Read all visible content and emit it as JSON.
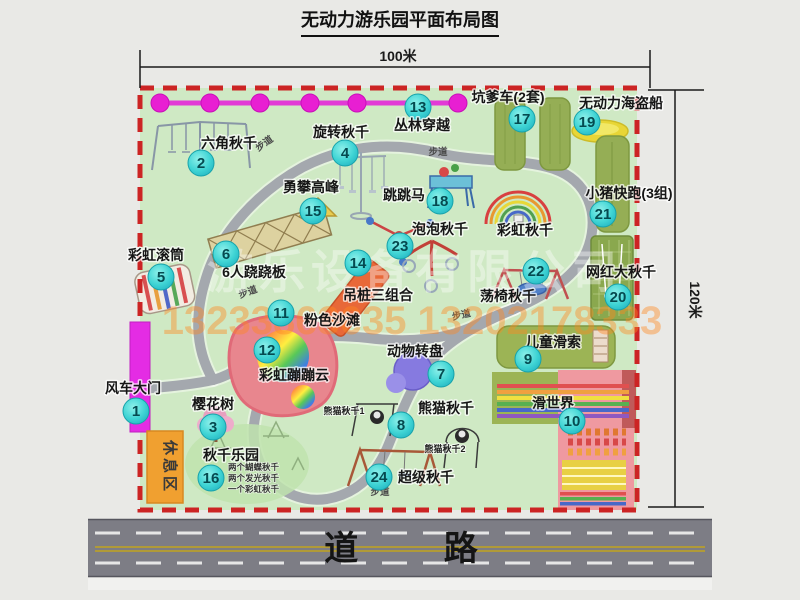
{
  "title": "无动力游乐园平面布局图",
  "dimensions": {
    "width": "100米",
    "height": "120米"
  },
  "road": {
    "label": "道 路"
  },
  "watermark": {
    "company": "游乐设备有限公司",
    "phone": "13233863635 13202178333"
  },
  "rest_area": "休息区",
  "walkway_label": "步道",
  "attractions": [
    {
      "num": "1",
      "label": "风车大门"
    },
    {
      "num": "2",
      "label": "六角秋千"
    },
    {
      "num": "3",
      "label": "樱花树"
    },
    {
      "num": "4",
      "label": "旋转秋千"
    },
    {
      "num": "5",
      "label": "彩虹滚筒"
    },
    {
      "num": "6",
      "label": "6人跷跷板"
    },
    {
      "num": "7",
      "label": "动物转盘"
    },
    {
      "num": "8",
      "label": "熊猫秋千"
    },
    {
      "num": "9",
      "label": "儿童滑索"
    },
    {
      "num": "10",
      "label": "滑世界"
    },
    {
      "num": "11",
      "label": "粉色沙滩"
    },
    {
      "num": "12",
      "label": "彩虹蹦蹦云"
    },
    {
      "num": "13",
      "label": "丛林穿越"
    },
    {
      "num": "14",
      "label": "吊桩三组合"
    },
    {
      "num": "15",
      "label": "勇攀高峰"
    },
    {
      "num": "16",
      "label": "秋千乐园",
      "notes": [
        "两个蝴蝶秋千",
        "两个发光秋千",
        "一个彩虹秋千"
      ]
    },
    {
      "num": "17",
      "label": "坑爹车(2套)"
    },
    {
      "num": "18",
      "label": "跳跳马"
    },
    {
      "num": "19",
      "label": "无动力海盗船"
    },
    {
      "num": "20",
      "label": "网红大秋千"
    },
    {
      "num": "21",
      "label": "小猪快跑(3组)"
    },
    {
      "num": "22",
      "label": "荡椅秋千"
    },
    {
      "num": "23",
      "label": "泡泡秋千"
    },
    {
      "num": "24",
      "label": "超级秋千"
    }
  ],
  "unnumbered_labels": {
    "rainbow_swing": "彩虹秋千",
    "panda_swing_1": "熊猫秋千1",
    "panda_swing_2": "熊猫秋千2"
  },
  "colors": {
    "map_green": "#cfe9c4",
    "border_red": "#cc2424",
    "badge_cyan": "#3fd4d4",
    "gate_magenta": "#e42ce4",
    "rest_orange": "#f0a030",
    "road_gray": "#7d7d85"
  }
}
